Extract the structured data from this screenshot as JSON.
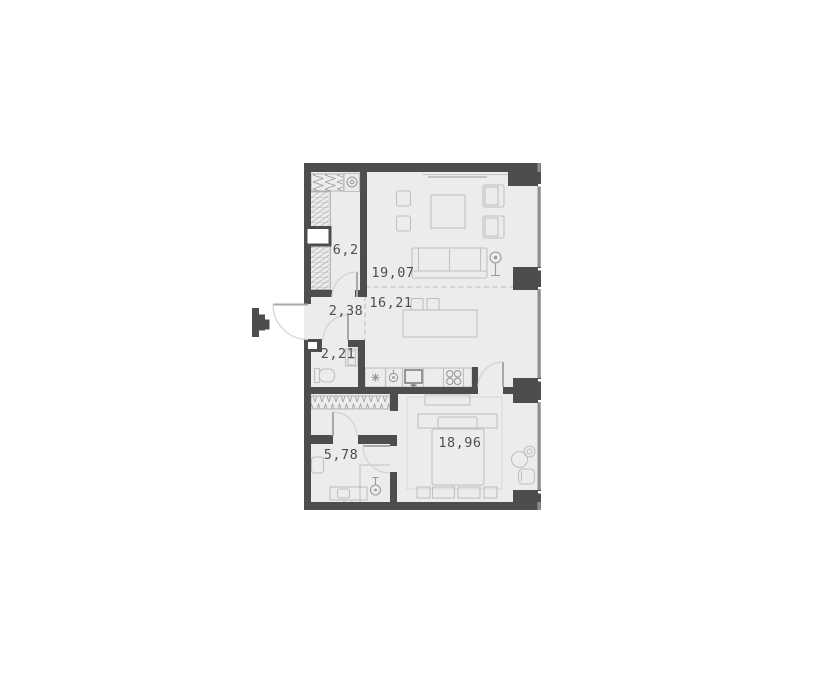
{
  "floor_plan": {
    "title": "apartment-floor-plan",
    "rooms": [
      {
        "id": "dressing-room",
        "area": "6,21"
      },
      {
        "id": "living-room",
        "area": "19,07"
      },
      {
        "id": "kitchen-dining",
        "area": "16,21"
      },
      {
        "id": "hallway",
        "area": "2,38"
      },
      {
        "id": "wc",
        "area": "2,21"
      },
      {
        "id": "bathroom",
        "area": "5,78"
      },
      {
        "id": "bedroom",
        "area": "18,96"
      }
    ],
    "colors": {
      "background": "#ffffff",
      "floor_fill": "#ececec",
      "wall": "#4d4d4d",
      "window_line": "#8e8e8e",
      "furniture_stroke": "#c0c0c0",
      "dashed_line": "#c6c6c6",
      "label_text": "#4f4f4f"
    }
  }
}
